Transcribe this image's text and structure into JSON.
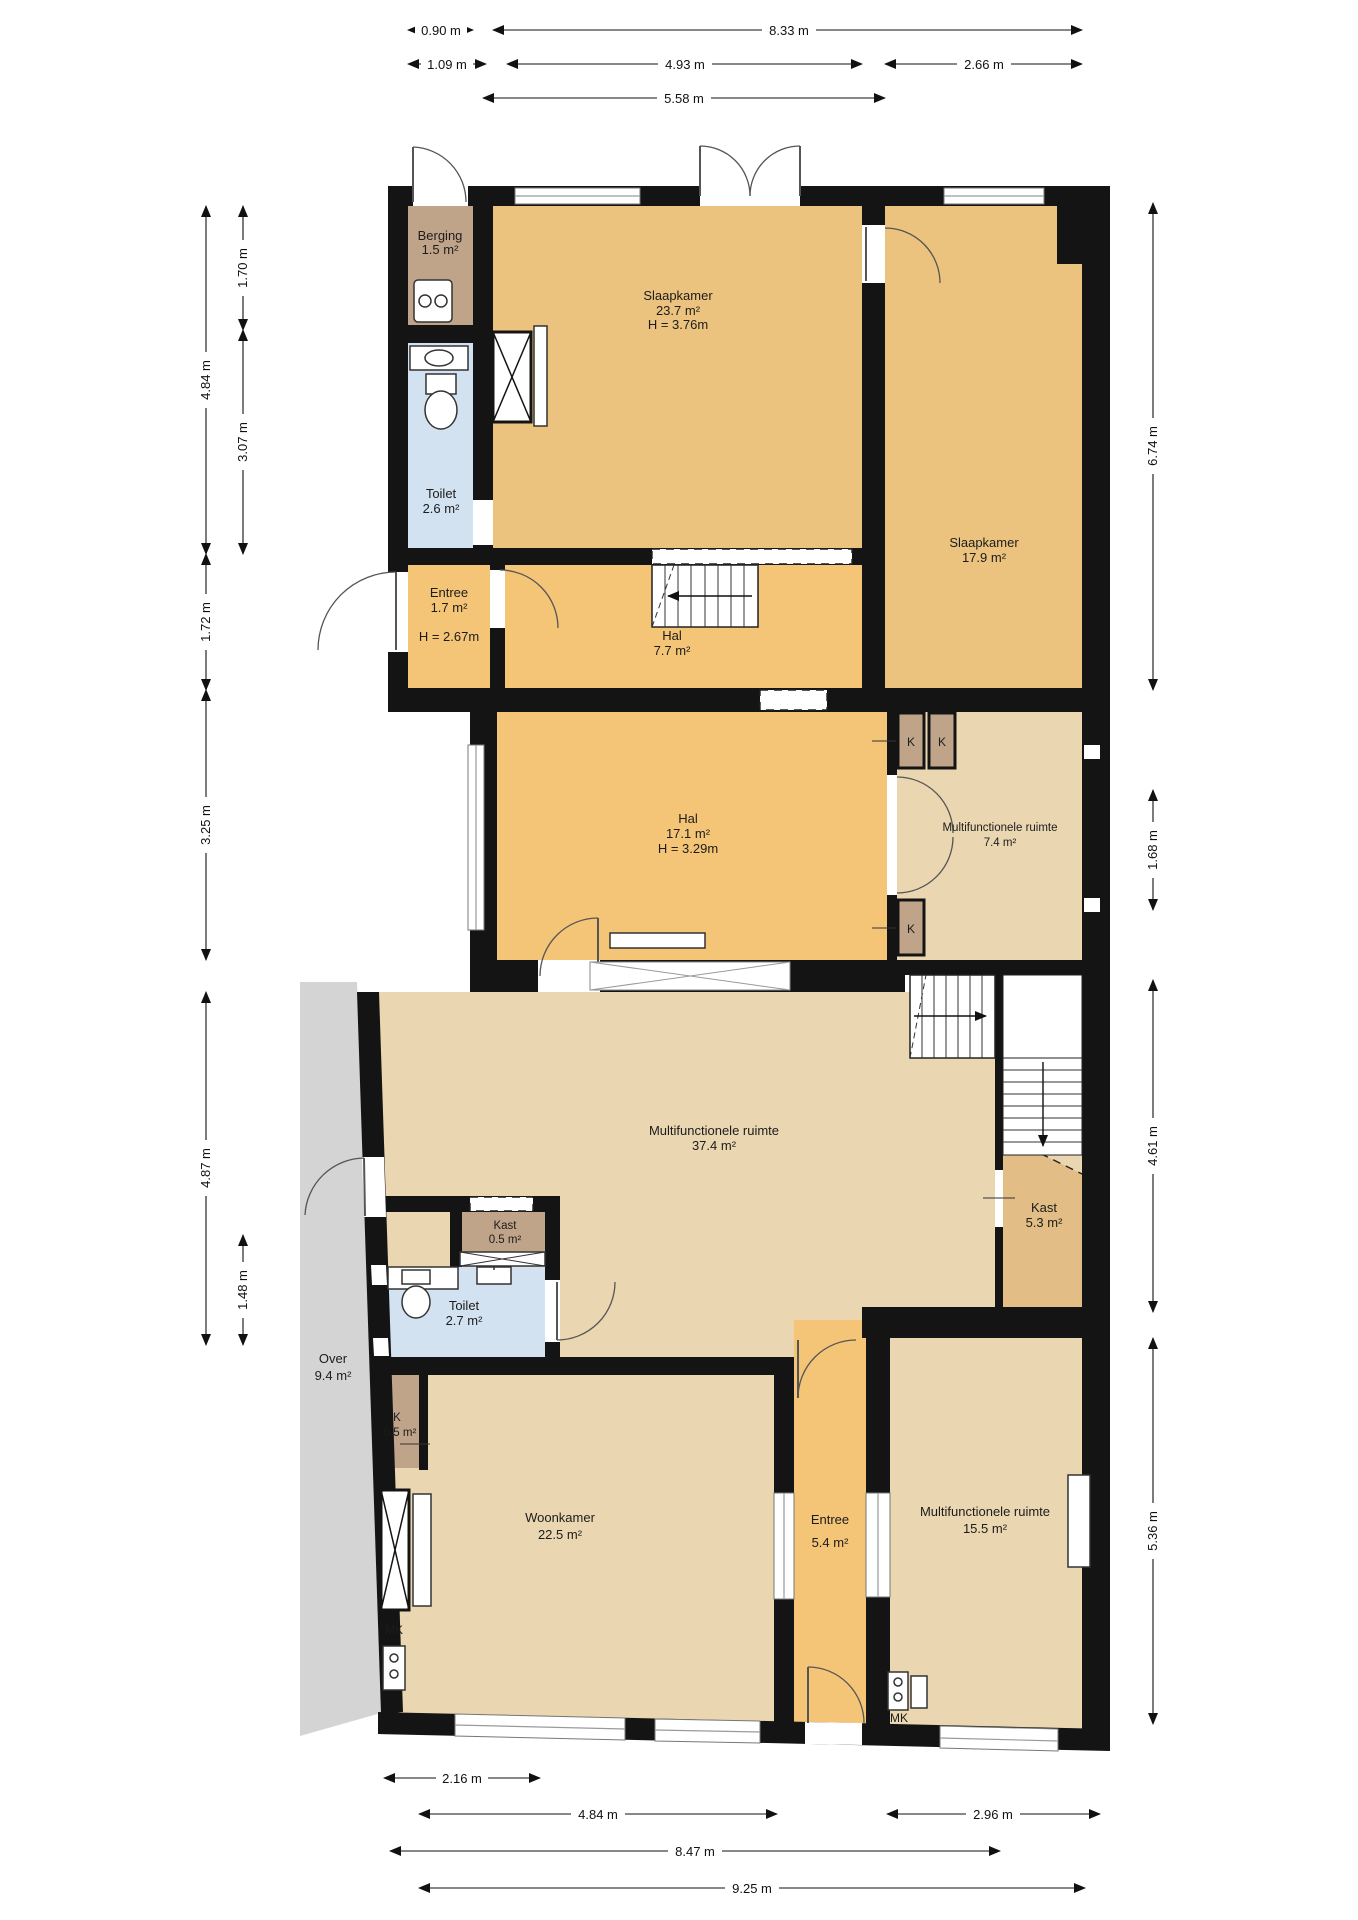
{
  "plan": {
    "title": "Floor plan",
    "rooms": {
      "berging": {
        "name": "Berging",
        "area": "1.5 m²"
      },
      "toilet_boven": {
        "name": "Toilet",
        "area": "2.6 m²"
      },
      "slaapkamer_groot": {
        "name": "Slaapkamer",
        "area": "23.7 m²",
        "height": "H = 3.76m"
      },
      "slaapkamer_klein": {
        "name": "Slaapkamer",
        "area": "17.9 m²"
      },
      "entree_boven": {
        "name": "Entree",
        "area": "1.7 m²",
        "height": "H = 2.67m"
      },
      "hal_klein": {
        "name": "Hal",
        "area": "7.7 m²"
      },
      "hal_groot": {
        "name": "Hal",
        "area": "17.1 m²",
        "height": "H = 3.29m"
      },
      "multi_klein": {
        "name": "Multifunctionele ruimte",
        "area": "7.4 m²"
      },
      "multi_groot": {
        "name": "Multifunctionele ruimte",
        "area": "37.4 m²"
      },
      "kast_klein": {
        "name": "Kast",
        "area": "0.5 m²"
      },
      "toilet_beneden": {
        "name": "Toilet",
        "area": "2.7 m²"
      },
      "kast_groot": {
        "name": "Kast",
        "area": "5.3 m²"
      },
      "over": {
        "name": "Over",
        "area": "9.4 m²"
      },
      "woonkamer": {
        "name": "Woonkamer",
        "area": "22.5 m²"
      },
      "k_beneden": {
        "name": "K",
        "area": "0.5 m²"
      },
      "entree_beneden": {
        "name": "Entree",
        "area": "5.4 m²"
      },
      "multi_onder": {
        "name": "Multifunctionele ruimte",
        "area": "15.5 m²"
      }
    },
    "closet_labels": {
      "k1": "K",
      "k2": "K",
      "k3": "K",
      "mk_left": "MK",
      "mk_right": "MK"
    },
    "dimensions": {
      "top": [
        "0.90 m",
        "8.33 m",
        "1.09 m",
        "4.93 m",
        "2.66 m",
        "5.58 m"
      ],
      "left": [
        "4.84 m",
        "1.70 m",
        "3.07 m",
        "1.72 m",
        "3.25 m",
        "4.87 m",
        "1.48 m"
      ],
      "right": [
        "6.74 m",
        "1.68 m",
        "4.61 m",
        "5.36 m"
      ],
      "bottom": [
        "2.16 m",
        "4.84 m",
        "2.96 m",
        "8.47 m",
        "9.25 m"
      ]
    },
    "colors": {
      "wall": "#141414",
      "tan": "#ebc37e",
      "orange": "#f5c577",
      "light": "#ead7b2",
      "brown": "#c0a489",
      "blue": "#d3e2f0",
      "gray": "#d4d4d4",
      "darktan": "#e2bd85"
    }
  }
}
